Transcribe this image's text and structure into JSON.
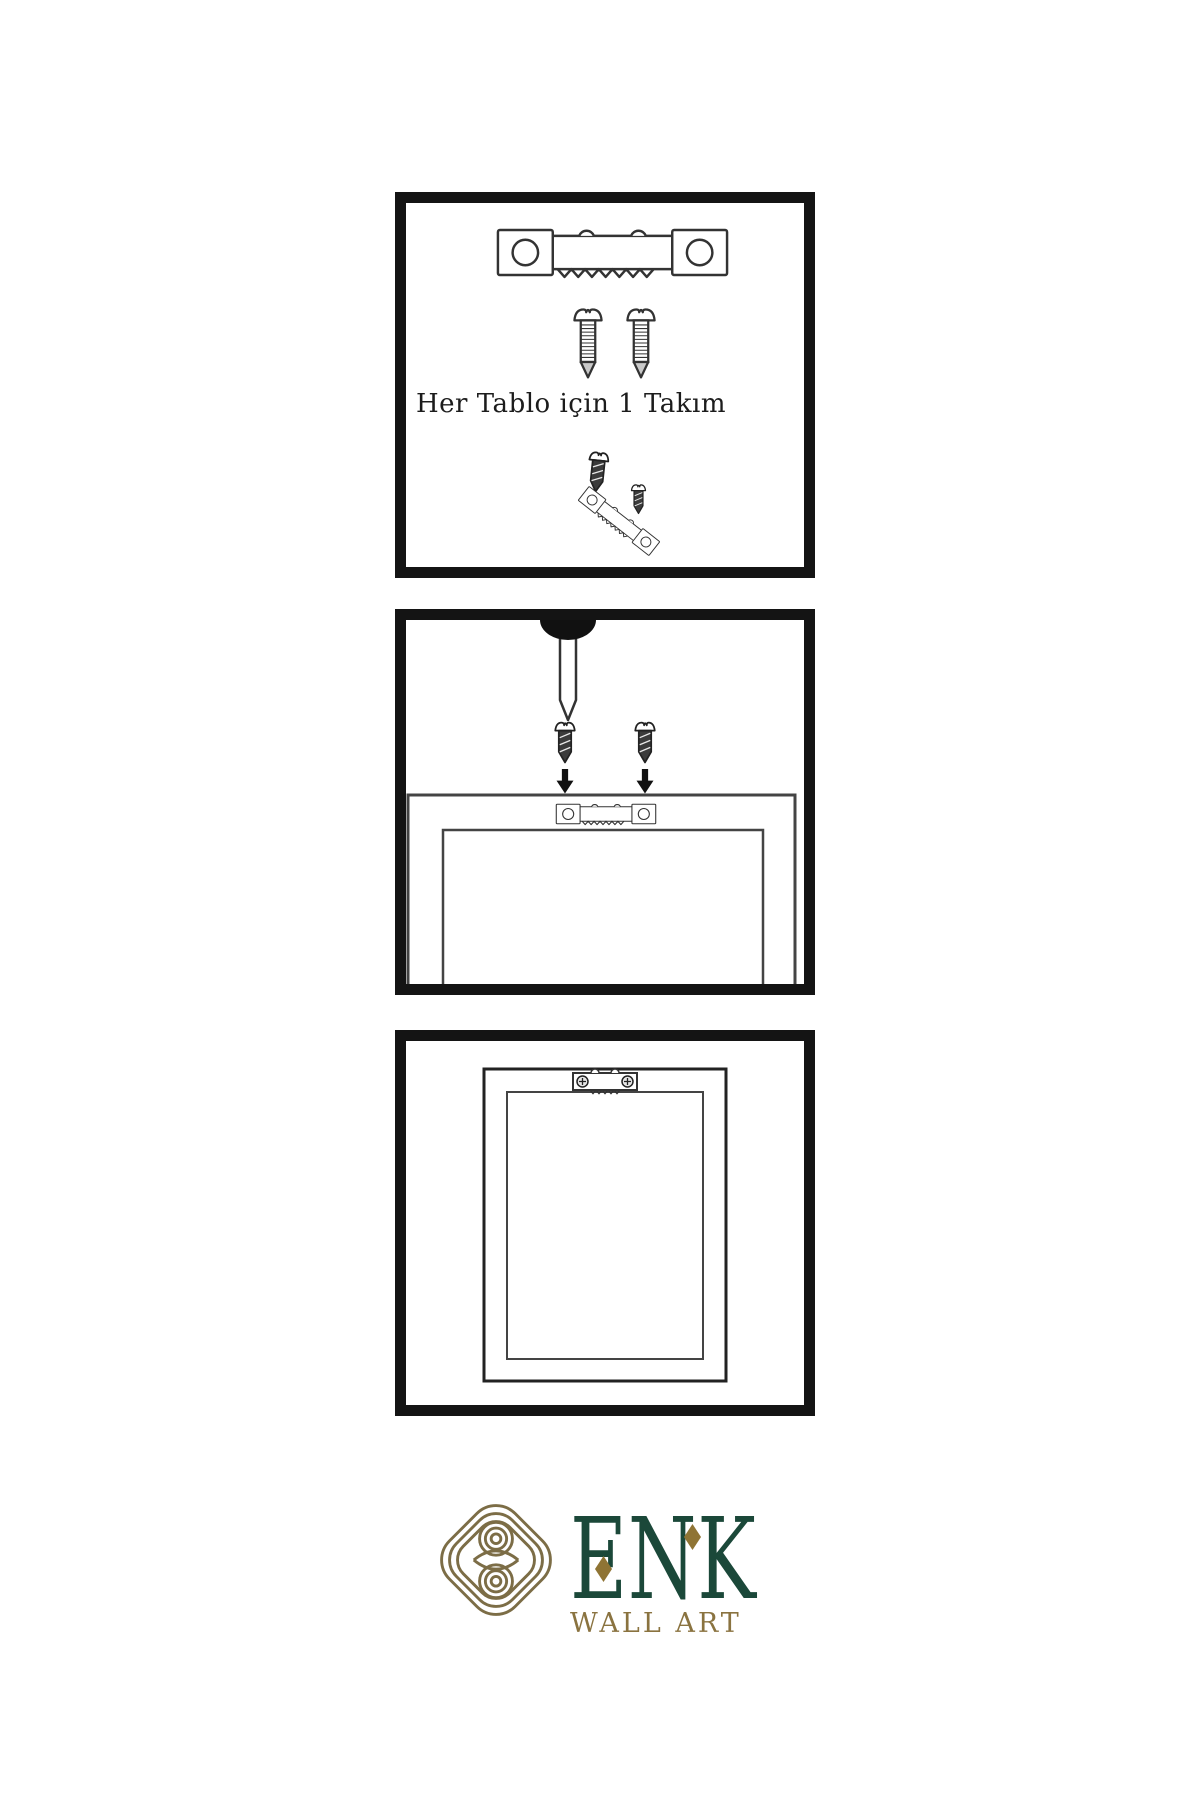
{
  "page": {
    "background_color": "#ffffff",
    "panel_border_color": "#141414",
    "line_art_color": "#333333"
  },
  "instructions": {
    "panel1": {
      "caption": "Her Tablo için 1 Takım",
      "icons": [
        "sawtooth-hanger-icon",
        "screw-icon",
        "screw-icon",
        "screw-into-hanger-icon"
      ]
    },
    "panel2": {
      "icons": [
        "nail-icon",
        "screw-icon",
        "screw-icon",
        "arrow-down-icon",
        "arrow-down-icon",
        "frame-back-icon",
        "sawtooth-hanger-icon"
      ]
    },
    "panel3": {
      "icons": [
        "frame-front-icon",
        "mounted-sawtooth-hanger-icon"
      ]
    }
  },
  "logo": {
    "brand": "ENK",
    "tagline": "WALL ART",
    "colors": {
      "brand_green": "#1b4839",
      "diamond_gold": "#8f7434",
      "tagline_gold": "#8a7340",
      "knot_gold": "#7c6d46"
    }
  }
}
